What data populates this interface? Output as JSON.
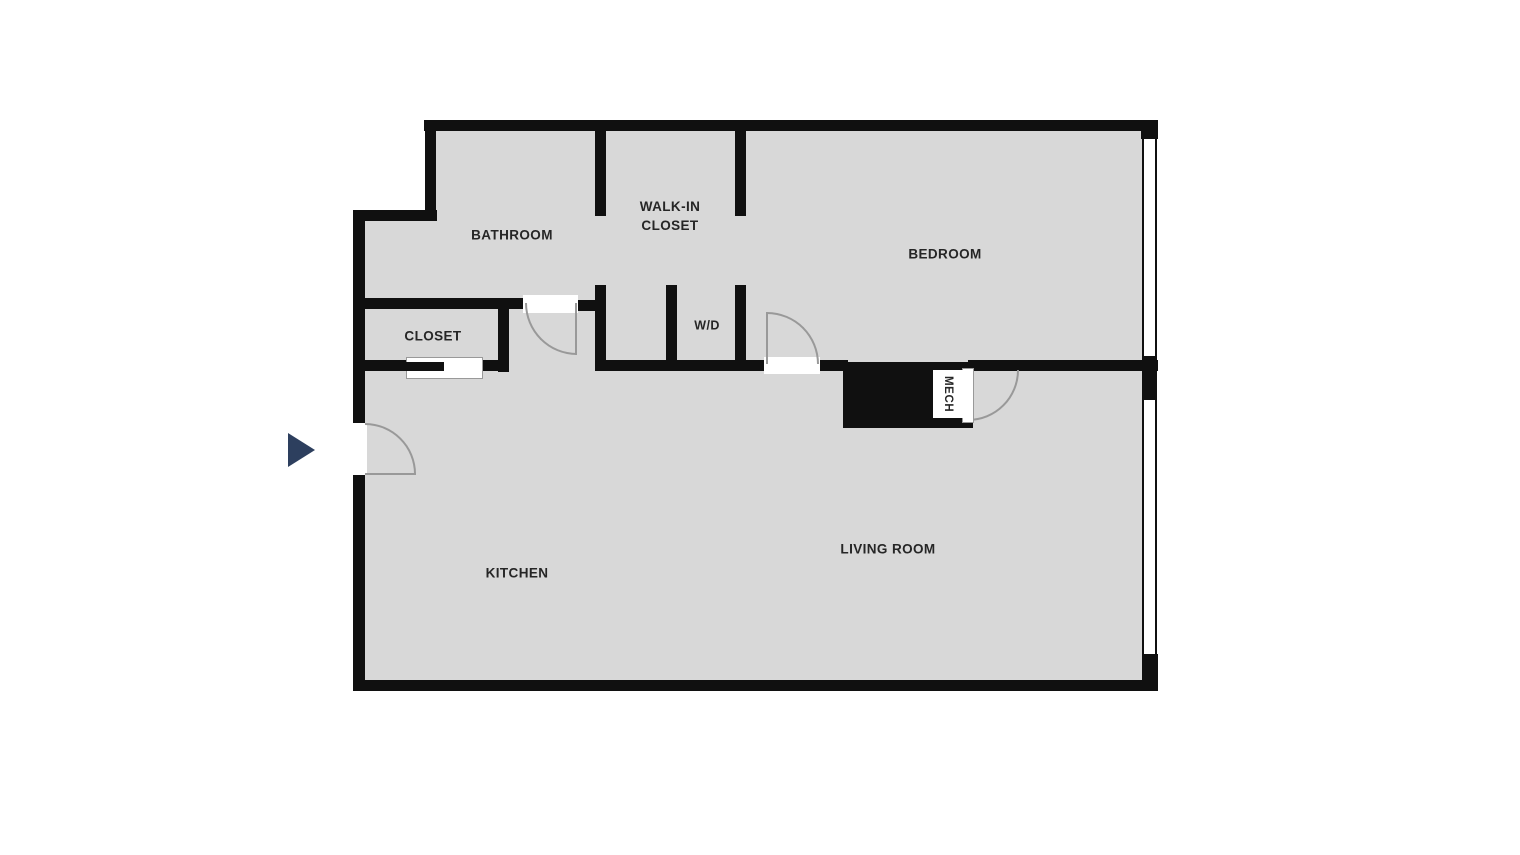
{
  "plan": {
    "type": "apartment-floor-plan",
    "rooms": {
      "bathroom": "BATHROOM",
      "walk_in_closet_line1": "WALK-IN",
      "walk_in_closet_line2": "CLOSET",
      "bedroom": "BEDROOM",
      "closet": "CLOSET",
      "washer_dryer": "W/D",
      "mech": "MECH",
      "kitchen": "KITCHEN",
      "living_room": "LIVING ROOM"
    },
    "colors": {
      "background": "#ffffff",
      "floor": "#d8d8d8",
      "wall": "#101010",
      "door_arc": "#999999",
      "window": "#ffffff",
      "entry_arrow": "#2d3f5e",
      "label": "#262626"
    }
  }
}
